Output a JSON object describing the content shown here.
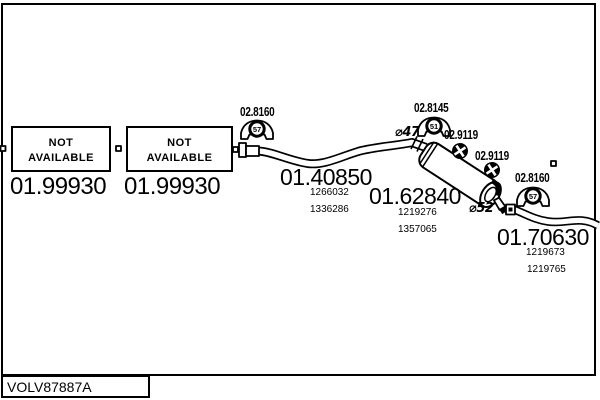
{
  "plate": {
    "id": "VOLV87887A"
  },
  "not_available_boxes": [
    {
      "line1": "NOT",
      "line2": "AVAILABLE",
      "code": "01.99930"
    },
    {
      "line1": "NOT",
      "line2": "AVAILABLE",
      "code": "01.99930"
    }
  ],
  "parts": {
    "front_pipe": {
      "code": "01.40850",
      "oe_numbers": [
        "1266032",
        "1336286"
      ]
    },
    "middle_muffler": {
      "code": "01.62840",
      "oe_numbers": [
        "1219276",
        "1357065"
      ]
    },
    "tail_pipe": {
      "code": "01.70630",
      "oe_numbers": [
        "1219673",
        "1219765"
      ]
    }
  },
  "clamps": [
    {
      "code": "02.8160",
      "size": "57"
    },
    {
      "code": "02.8145",
      "size": "51"
    },
    {
      "code": "02.8160",
      "size": "57"
    }
  ],
  "hangers": [
    {
      "code": "02.9119"
    },
    {
      "code": "02.9119"
    }
  ],
  "diameters": [
    {
      "label": "⌀47"
    },
    {
      "label": "⌀52"
    }
  ],
  "colors": {
    "ink": "#000000",
    "background": "#ffffff"
  }
}
